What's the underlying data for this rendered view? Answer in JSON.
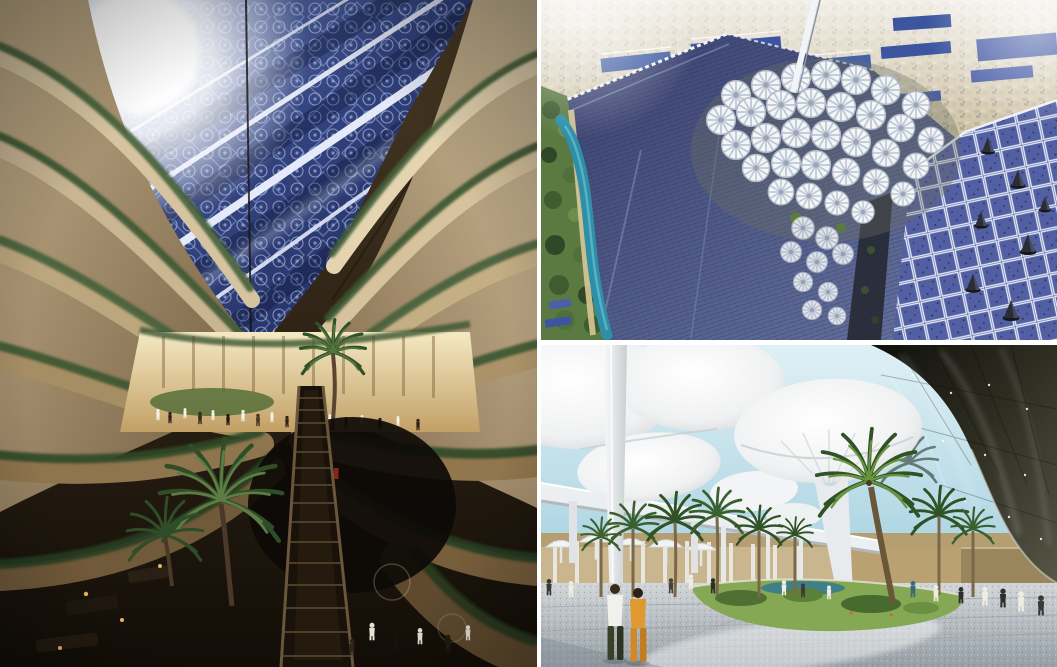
{
  "window": {
    "width_px": 1057,
    "height_px": 667,
    "kind": "photo collage of three architectural renderings"
  },
  "collage": {
    "divider_color": "#ffffff",
    "panels": [
      {
        "id": "atrium-interior",
        "position": "left",
        "bounds_px": {
          "x": 0,
          "y": 0,
          "w": 537,
          "h": 667
        },
        "description": "Interior atrium: tall curved stone terraces draped with hanging plants converge under a skylight of blue Islamic geometric lattice panels crossed by bright diagonal beams; sunlight bursts at the upper left; a warm glowing shopping level with small crowds and palm trees sits mid-frame above a dark lower court with a long central escalator and lounge seating.",
        "colors": {
          "roof_blue": "#2b3c76",
          "beam_white": "#eef3ff",
          "stone_light": "#d6c4a0",
          "stone_dark": "#6b5538",
          "plants_green": "#3f5c33",
          "plaza_glow": "#f2e4bc",
          "lower_brown": "#1c140c",
          "escalator_dark": "#241a0e"
        }
      },
      {
        "id": "aerial-solar-city",
        "position": "top-right",
        "bounds_px": {
          "x": 541,
          "y": 0,
          "w": 516,
          "h": 340
        },
        "description": "Aerial rendering of a desert eco-city: vast diagonal rooftops of dark blue photovoltaic panels, a central cluster of white pinwheel flower canopies, a white mast rising from the cluster, a green tree belt with a winding teal stream on the left, hazy beige city sprawl on the horizon, and a lighter gridded solar roof with dark ventilation cones at the right.",
        "colors": {
          "haze_city": "#d3c8ac",
          "solar_dark": "#39406e",
          "solar_light": "#7d8cc0",
          "grid_white": "#e8ecf4",
          "flower_canopy": "#f4f6f8",
          "trees_green": "#4f6f3c",
          "river_teal": "#2e8fa8",
          "cone_dark": "#2a2d36"
        }
      },
      {
        "id": "plaza-canopies",
        "position": "bottom-right",
        "bounds_px": {
          "x": 541,
          "y": 345,
          "w": 516,
          "h": 322
        },
        "description": "Shaded plaza rendering: giant white mushroom canopies on slender white columns against patches of light blue sky, an elevated white monorail guideway on the left, palm trees around a green lawn island with a small teal pool, a dark glossy curved canopy building at the right, and people strolling on speckled grey paving — two foreground walkers, one in a white shirt and one in an orange outfit.",
        "colors": {
          "sky_blue": "#cfe8f0",
          "canopy_white": "#f4f6f7",
          "column_white": "#e9eced",
          "dark_glass": "#22221a",
          "pavement_grey": "#bfc6ca",
          "lawn_green": "#85a854",
          "pool_teal": "#3f7f86",
          "palm_green": "#2f5226",
          "orange_outfit": "#e09830",
          "monorail_white": "#eceff1",
          "back_wall_tan": "#c9b68e",
          "lit_wall_yellow": "#b5a14e"
        }
      }
    ]
  }
}
